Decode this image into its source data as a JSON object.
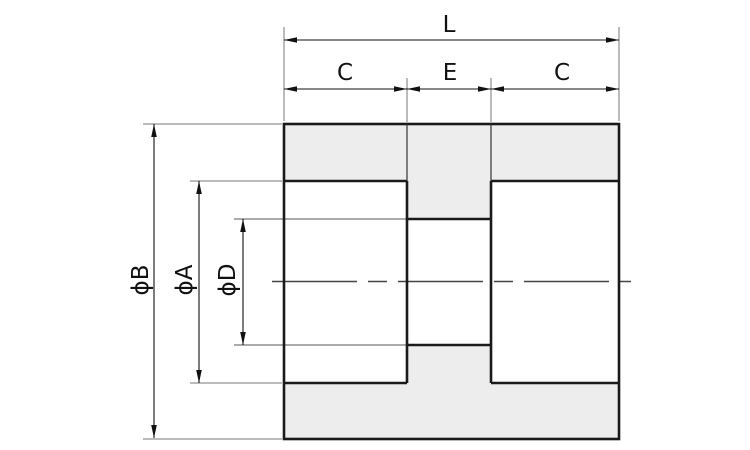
{
  "drawing": {
    "kind": "technical-drawing-cross-section",
    "part": "spacer-with-counterbores",
    "colors": {
      "background": "#ffffff",
      "section_fill": "#ededed",
      "outline": "#1a1a1a",
      "dimension_line": "#111111",
      "extension_line": "#777777",
      "centerline": "#444444"
    },
    "dimensions": {
      "overall_length": "L",
      "counterbore_depth_left": "C",
      "center_section_length": "E",
      "counterbore_depth_right": "C",
      "outer_diameter": "ϕB",
      "counterbore_diameter": "ϕA",
      "through_hole_diameter": "ϕD"
    }
  }
}
